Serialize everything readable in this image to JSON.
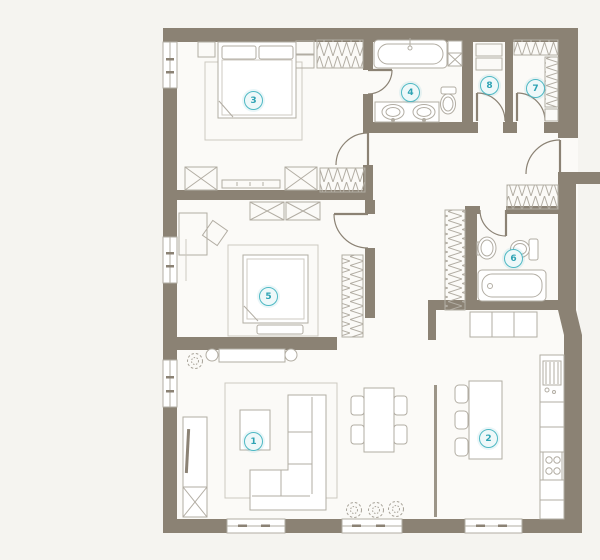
{
  "plan": {
    "rooms": [
      {
        "id": "living-room",
        "number": "1"
      },
      {
        "id": "kitchen",
        "number": "2"
      },
      {
        "id": "bedroom-master",
        "number": "3"
      },
      {
        "id": "bathroom-main",
        "number": "4"
      },
      {
        "id": "bedroom-second",
        "number": "5"
      },
      {
        "id": "bathroom-second",
        "number": "6"
      },
      {
        "id": "closet-right",
        "number": "7"
      },
      {
        "id": "closet-entry",
        "number": "8"
      }
    ],
    "colors": {
      "wall": "#8b8274",
      "accent": "#4fb9c4",
      "floor": "#fbfaf7",
      "background": "#f5f4f0",
      "furniture_line": "#b2ada3"
    }
  }
}
